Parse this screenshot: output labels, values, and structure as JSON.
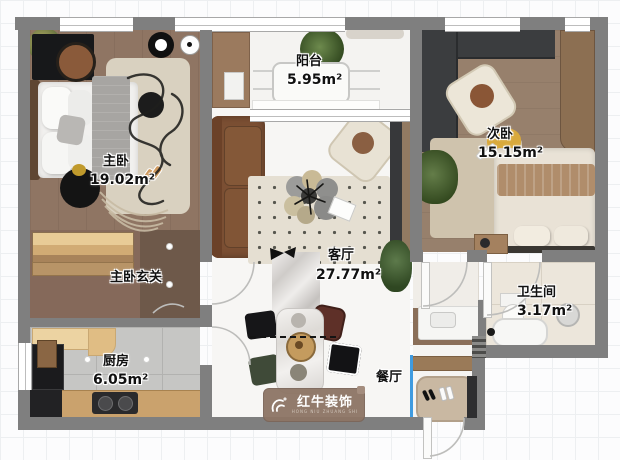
{
  "document": {
    "type": "apartment-floor-plan"
  },
  "labels": {
    "master_bedroom": {
      "name": "主卧",
      "area": "19.02m²"
    },
    "master_hall": {
      "name": "主卧玄关"
    },
    "kitchen": {
      "name": "厨房",
      "area": "6.05m²"
    },
    "balcony": {
      "name": "阳台",
      "area": "5.95m²"
    },
    "living_room": {
      "name": "客厅",
      "area": "27.77m²"
    },
    "dining_room": {
      "name": "餐厅"
    },
    "second_bedroom": {
      "name": "次卧",
      "area": "15.15m²"
    },
    "bathroom": {
      "name": "卫生间",
      "area": "3.17m²"
    }
  },
  "watermark": {
    "brand": "红牛装饰",
    "sub": "HONG NIU ZHUANG SHI"
  },
  "colors": {
    "wall": "#7f7f7f",
    "master_floor": "#8f7563",
    "second_floor": "#97806c",
    "kitchen_tile": "#c6c6c4",
    "bath_tile": "#ece6db",
    "living_floor": "#f7f6f4",
    "accent_blue": "#3f9be0",
    "watermark_bg": "#8d7565"
  }
}
